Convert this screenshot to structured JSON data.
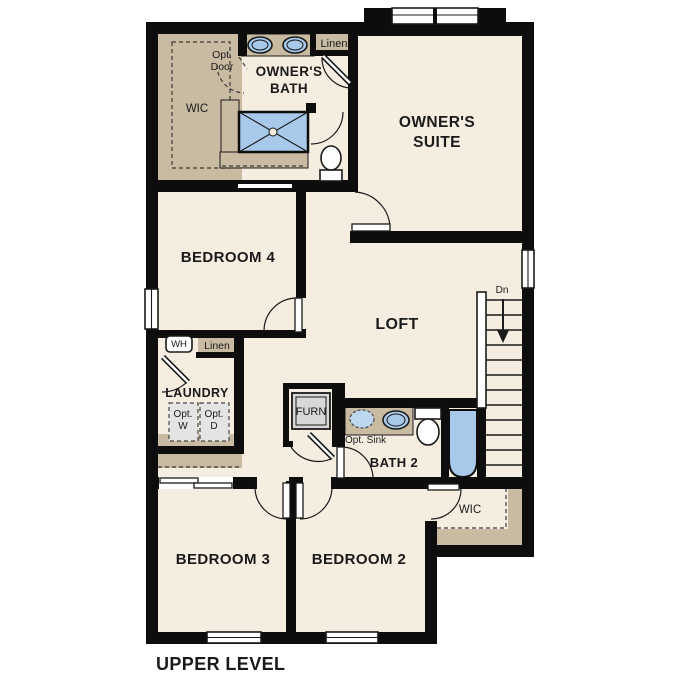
{
  "title": "UPPER LEVEL",
  "colors": {
    "floor_cream": "#f5eee0",
    "cabinet_tan": "#c9bba2",
    "fixture_blue": "#a8c9e9",
    "wall_black": "#0d0d0d",
    "appliance_gray": "#e4e4e4",
    "furnace_gray": "#d8d8d8"
  },
  "labels": {
    "owners_suite": [
      "OWNER'S",
      "SUITE"
    ],
    "owners_bath": [
      "OWNER'S",
      "BATH"
    ],
    "wic_upper": "WIC",
    "opt_door": [
      "Opt.",
      "Door"
    ],
    "linen_upper": "Linen",
    "bedroom4": "BEDROOM 4",
    "loft": "LOFT",
    "dn": "Dn",
    "wh": "WH",
    "linen_lower": "Linen",
    "laundry": "LAUNDRY",
    "opt_w": [
      "Opt.",
      "W"
    ],
    "opt_d": [
      "Opt.",
      "D"
    ],
    "furn": "FURN",
    "opt_sink": "Opt. Sink",
    "bath2": "BATH 2",
    "wic_lower": "WIC",
    "bedroom3": "BEDROOM 3",
    "bedroom2": "BEDROOM 2"
  }
}
